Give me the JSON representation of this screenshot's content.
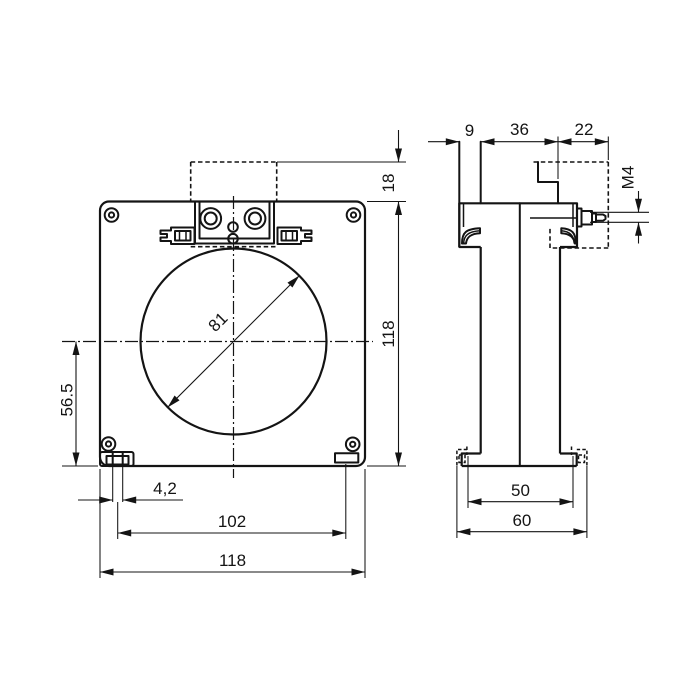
{
  "dims": {
    "front_top_offset": "18",
    "front_height": "118",
    "hole_diameter": "81",
    "hole_center_from_bottom": "56.5",
    "foot_slot_width": "4,2",
    "foot_hole_spacing": "102",
    "front_width": "118",
    "side_strip_depth": "9",
    "side_body_depth": "36",
    "side_cover_depth": "22",
    "terminal_thread": "M4",
    "base_inner_width": "50",
    "base_outer_width": "60"
  }
}
